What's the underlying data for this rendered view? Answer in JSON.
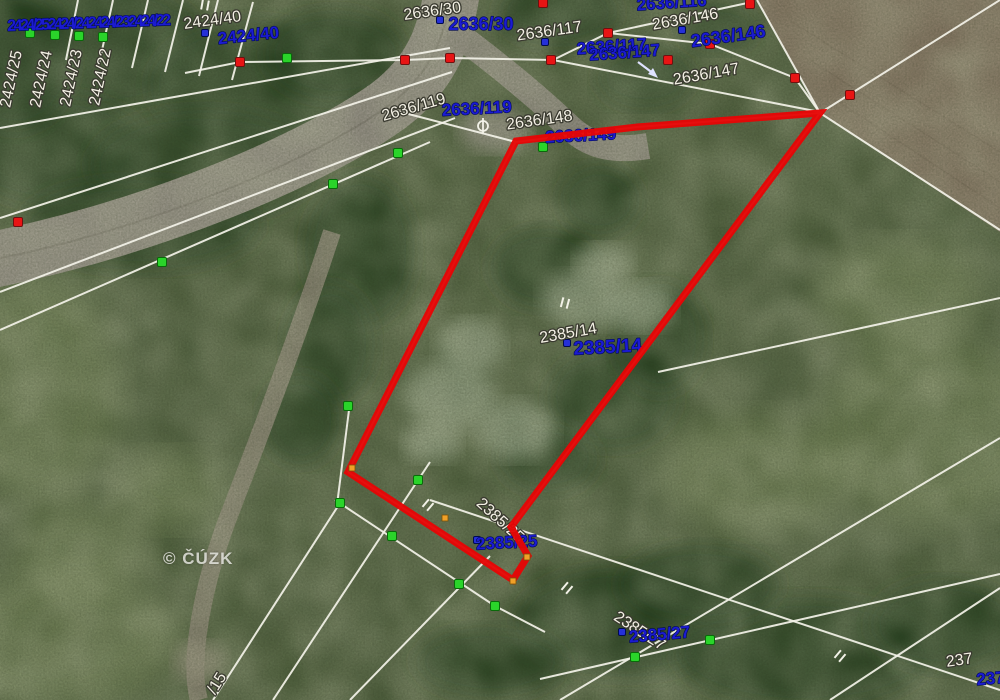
{
  "map": {
    "watermark": "© ČÚZK",
    "colors": {
      "highlight": "#e60505",
      "line_white": "#f3f2e8",
      "label_white": "#f3f0e4",
      "label_halo": "#3a3a30",
      "label_blue": "#1b1bd1",
      "label_blue_halo": "#000a50",
      "dot_red": "#e81414",
      "dot_green": "#2ad42a",
      "dot_blue": "#2530d8",
      "dot_orange": "#f0a028"
    },
    "selected_parcel": {
      "number": "2385/14",
      "outline_points": [
        [
          820,
          113
        ],
        [
          637,
          127
        ],
        [
          516,
          141
        ],
        [
          348,
          472
        ],
        [
          513,
          580
        ],
        [
          528,
          556
        ],
        [
          511,
          527
        ]
      ],
      "outline_width": 7
    },
    "labels_white": [
      {
        "t": "2424/25",
        "x": 16,
        "y": 80,
        "r": -78,
        "s": 16
      },
      {
        "t": "2424/24",
        "x": 46,
        "y": 80,
        "r": -78,
        "s": 16
      },
      {
        "t": "2424/23",
        "x": 76,
        "y": 79,
        "r": -78,
        "s": 16
      },
      {
        "t": "2424/22",
        "x": 105,
        "y": 78,
        "r": -78,
        "s": 16
      },
      {
        "t": "2424/40",
        "x": 213,
        "y": 25,
        "r": -8,
        "s": 16
      },
      {
        "t": "2636/30",
        "x": 433,
        "y": 16,
        "r": -8,
        "s": 16
      },
      {
        "t": "2636/117",
        "x": 550,
        "y": 36,
        "r": -8,
        "s": 16
      },
      {
        "t": "2636/146",
        "x": 686,
        "y": 24,
        "r": -10,
        "s": 16
      },
      {
        "t": "2636/147",
        "x": 707,
        "y": 79,
        "r": -10,
        "s": 16
      },
      {
        "t": "2636/119",
        "x": 415,
        "y": 112,
        "r": -16,
        "s": 16
      },
      {
        "t": "2636/148",
        "x": 540,
        "y": 125,
        "r": -8,
        "s": 16
      },
      {
        "t": "2385/14",
        "x": 569,
        "y": 338,
        "r": -10,
        "s": 16
      },
      {
        "t": "2385/25",
        "x": 497,
        "y": 524,
        "r": 42,
        "s": 16
      },
      {
        "t": "2385/27",
        "x": 637,
        "y": 635,
        "r": 33,
        "s": 16
      },
      {
        "t": "237",
        "x": 960,
        "y": 665,
        "r": -8,
        "s": 16
      },
      {
        "t": "/15",
        "x": 221,
        "y": 686,
        "r": -58,
        "s": 16
      }
    ],
    "labels_blue": [
      {
        "t": "2424/252424/242424/232424/22",
        "x": 88,
        "y": 28,
        "r": -2,
        "s": 16,
        "sp": -2.5
      },
      {
        "t": "2424/40",
        "x": 249,
        "y": 41,
        "r": -6,
        "s": 17
      },
      {
        "t": "2636/129",
        "x": 436,
        "y": -1,
        "r": 0,
        "s": 18
      },
      {
        "t": "2636/30",
        "x": 481,
        "y": 30,
        "r": 0,
        "s": 18
      },
      {
        "t": "2636/116",
        "x": 672,
        "y": 8,
        "r": -4,
        "s": 17
      },
      {
        "t": "2636/117",
        "x": 612,
        "y": 52,
        "r": -4,
        "s": 17
      },
      {
        "t": "2636/146",
        "x": 729,
        "y": 42,
        "r": -8,
        "s": 18
      },
      {
        "t": "2636/147",
        "x": 625,
        "y": 58,
        "r": -4,
        "s": 17
      },
      {
        "t": "2636/119",
        "x": 477,
        "y": 114,
        "r": -3,
        "s": 17
      },
      {
        "t": "2636/149",
        "x": 581,
        "y": 141,
        "r": -3,
        "s": 17
      },
      {
        "t": "2385/14",
        "x": 608,
        "y": 353,
        "r": -3,
        "s": 19
      },
      {
        "t": "2385/25",
        "x": 507,
        "y": 548,
        "r": -3,
        "s": 17
      },
      {
        "t": "2385/27",
        "x": 660,
        "y": 640,
        "r": -5,
        "s": 17
      },
      {
        "t": "237",
        "x": 991,
        "y": 684,
        "r": -5,
        "s": 17
      }
    ],
    "lines": [
      [
        [
          78,
          0
        ],
        [
          66,
          60
        ]
      ],
      [
        [
          113,
          0
        ],
        [
          99,
          64
        ]
      ],
      [
        [
          148,
          0
        ],
        [
          132,
          68
        ]
      ],
      [
        [
          183,
          0
        ],
        [
          165,
          72
        ]
      ],
      [
        [
          218,
          0
        ],
        [
          199,
          76
        ]
      ],
      [
        [
          253,
          2
        ],
        [
          232,
          80
        ]
      ],
      [
        [
          0,
          128
        ],
        [
          450,
          48
        ]
      ],
      [
        [
          185,
          73
        ],
        [
          240,
          62
        ],
        [
          405,
          60
        ],
        [
          450,
          58
        ],
        [
          553,
          60
        ],
        [
          608,
          33
        ],
        [
          752,
          2
        ]
      ],
      [
        [
          0,
          218
        ],
        [
          452,
          72
        ]
      ],
      [
        [
          0,
          292
        ],
        [
          455,
          118
        ]
      ],
      [
        [
          0,
          330
        ],
        [
          430,
          142
        ]
      ],
      [
        [
          393,
          110
        ],
        [
          516,
          142
        ]
      ],
      [
        [
          516,
          142
        ],
        [
          637,
          127
        ],
        [
          820,
          113
        ]
      ],
      [
        [
          608,
          33
        ],
        [
          710,
          44
        ],
        [
          795,
          78
        ],
        [
          820,
          113
        ]
      ],
      [
        [
          553,
          60
        ],
        [
          820,
          112
        ]
      ],
      [
        [
          820,
          113
        ],
        [
          1000,
          0
        ]
      ],
      [
        [
          757,
          0
        ],
        [
          820,
          113
        ]
      ],
      [
        [
          820,
          113
        ],
        [
          1000,
          230
        ]
      ],
      [
        [
          658,
          372
        ],
        [
          1000,
          298
        ]
      ],
      [
        [
          820,
          113
        ],
        [
          511,
          528
        ]
      ],
      [
        [
          516,
          141
        ],
        [
          348,
          472
        ]
      ],
      [
        [
          348,
          472
        ],
        [
          513,
          580
        ]
      ],
      [
        [
          335,
          500
        ],
        [
          495,
          606
        ],
        [
          545,
          632
        ]
      ],
      [
        [
          213,
          700
        ],
        [
          340,
          503
        ]
      ],
      [
        [
          273,
          700
        ],
        [
          430,
          462
        ]
      ],
      [
        [
          350,
          700
        ],
        [
          490,
          556
        ]
      ],
      [
        [
          430,
          500
        ],
        [
          1000,
          690
        ]
      ],
      [
        [
          540,
          679
        ],
        [
          1000,
          574
        ]
      ],
      [
        [
          560,
          700
        ],
        [
          1000,
          438
        ]
      ],
      [
        [
          830,
          700
        ],
        [
          1000,
          588
        ]
      ],
      [
        [
          350,
          402
        ],
        [
          337,
          505
        ]
      ]
    ],
    "dots": {
      "red": [
        [
          240,
          62
        ],
        [
          405,
          60
        ],
        [
          450,
          58
        ],
        [
          551,
          60
        ],
        [
          608,
          33
        ],
        [
          750,
          4
        ],
        [
          710,
          44
        ],
        [
          795,
          78
        ],
        [
          850,
          95
        ],
        [
          543,
          3
        ],
        [
          18,
          222
        ],
        [
          668,
          60
        ]
      ],
      "green": [
        [
          30,
          33
        ],
        [
          55,
          35
        ],
        [
          79,
          36
        ],
        [
          103,
          37
        ],
        [
          287,
          58
        ],
        [
          333,
          184
        ],
        [
          398,
          153
        ],
        [
          162,
          262
        ],
        [
          348,
          406
        ],
        [
          340,
          503
        ],
        [
          392,
          536
        ],
        [
          418,
          480
        ],
        [
          459,
          584
        ],
        [
          495,
          606
        ],
        [
          635,
          657
        ],
        [
          710,
          640
        ],
        [
          543,
          147
        ]
      ],
      "blue": [
        [
          205,
          33
        ],
        [
          440,
          20
        ],
        [
          545,
          42
        ],
        [
          682,
          30
        ],
        [
          567,
          343
        ],
        [
          477,
          540
        ],
        [
          622,
          632
        ]
      ],
      "orange": [
        [
          352,
          468
        ],
        [
          445,
          518
        ],
        [
          513,
          581
        ],
        [
          527,
          557
        ]
      ]
    },
    "symbols": {
      "parallel_ticks": [
        {
          "x": 205,
          "y": 5,
          "r": 10
        },
        {
          "x": 565,
          "y": 303,
          "r": 15
        },
        {
          "x": 428,
          "y": 505,
          "r": 40
        },
        {
          "x": 567,
          "y": 588,
          "r": 40
        },
        {
          "x": 840,
          "y": 656,
          "r": 40
        }
      ],
      "circle_cross": {
        "x": 483,
        "y": 126
      },
      "arrow": {
        "x1": 638,
        "y1": 62,
        "x2": 654,
        "y2": 74
      }
    }
  }
}
